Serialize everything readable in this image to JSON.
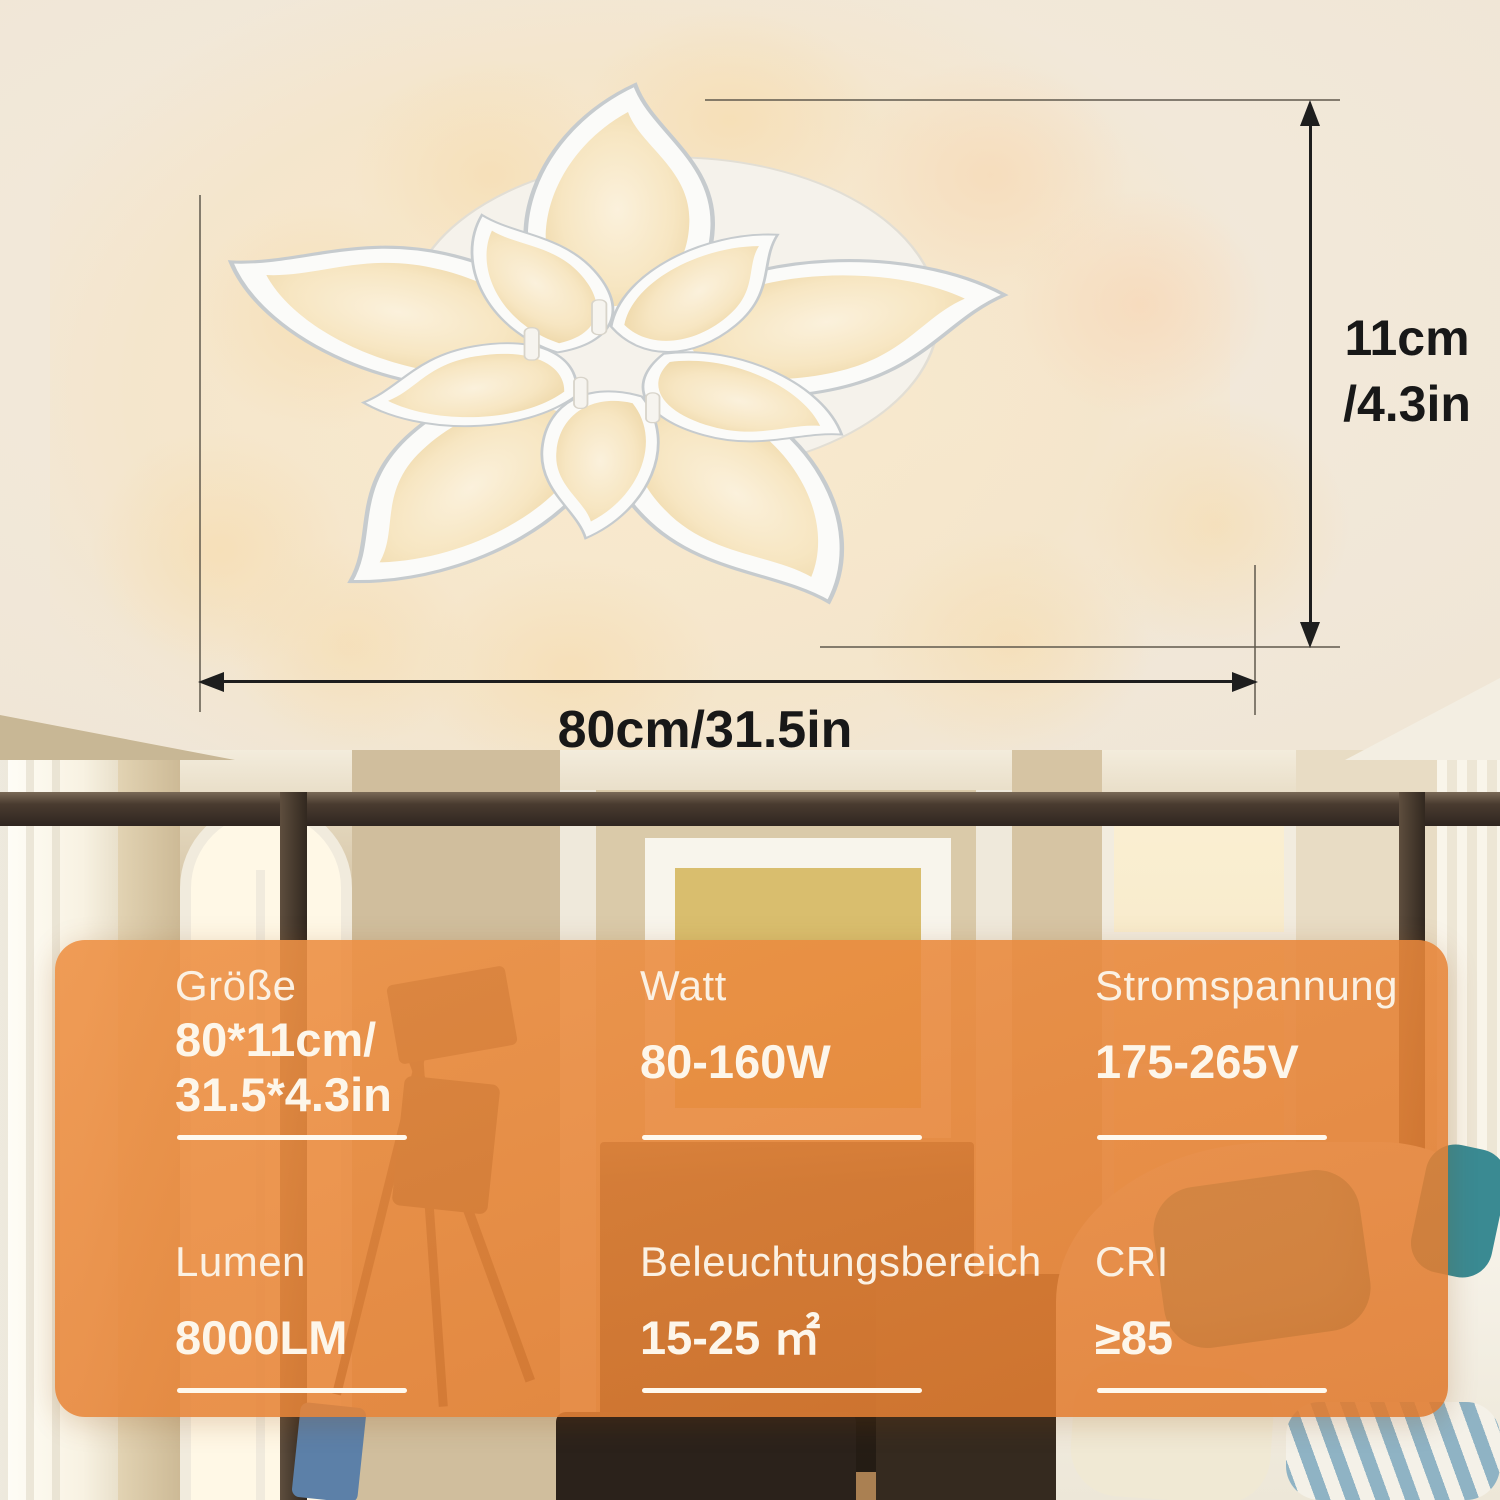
{
  "colors": {
    "panel_orange": "#E8853A",
    "glow_warm": "#F6E2BC",
    "text_cream": "#FCF3E6",
    "dimension_ink": "#1C1C1C",
    "pillow_teal": "#4F9FA4"
  },
  "diagram": {
    "height_dimension_line1": "11cm",
    "height_dimension_line2": "/4.3in",
    "width_dimension": "80cm/31.5in"
  },
  "spec_panel": {
    "cells": [
      {
        "label": "Größe",
        "value_lines": [
          "80*11cm/",
          "31.5*4.3in"
        ]
      },
      {
        "label": "Watt",
        "value_lines": [
          "80-160W"
        ]
      },
      {
        "label": "Stromspannung",
        "value_lines": [
          "175-265V"
        ]
      },
      {
        "label": "Lumen",
        "value_lines": [
          "8000LM"
        ]
      },
      {
        "label": "Beleuchtungsbereich",
        "value_lines": [
          "15-25 ㎡"
        ]
      },
      {
        "label": "CRI",
        "value_lines": [
          "≥85"
        ]
      }
    ]
  }
}
